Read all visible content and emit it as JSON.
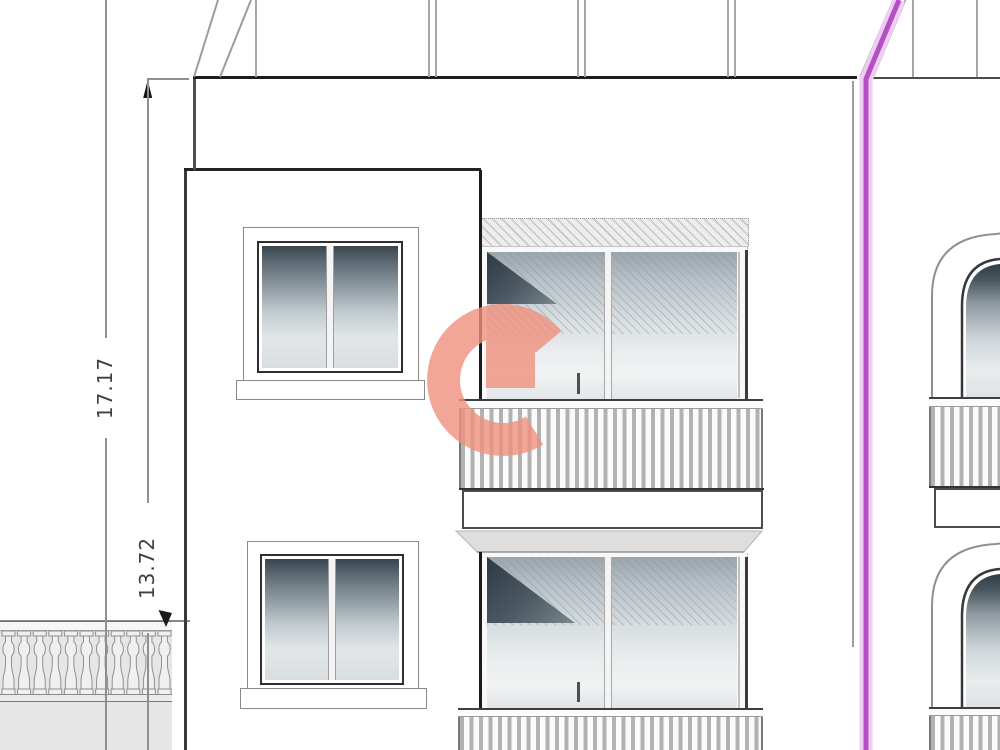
{
  "drawing": {
    "title": "building-facade-elevation",
    "dimensions": {
      "height_total": "17.17",
      "height_upper": "13.72"
    },
    "colors": {
      "boundary_magenta": "#b44fc4",
      "boundary_magenta_glow": "#eecdf2",
      "logo_salmon": "#f0917e",
      "line_dark": "#1d1d1d",
      "line_gray": "#9c9c9c",
      "glass_dark": "#2f3c45",
      "glass_light": "#e9eced",
      "terrace_fill": "#e6e6e6"
    },
    "elements": {
      "left_windows": 2,
      "glazed_balconies": 2,
      "arched_windows_right": 2,
      "terrace_balusters": 11
    }
  }
}
